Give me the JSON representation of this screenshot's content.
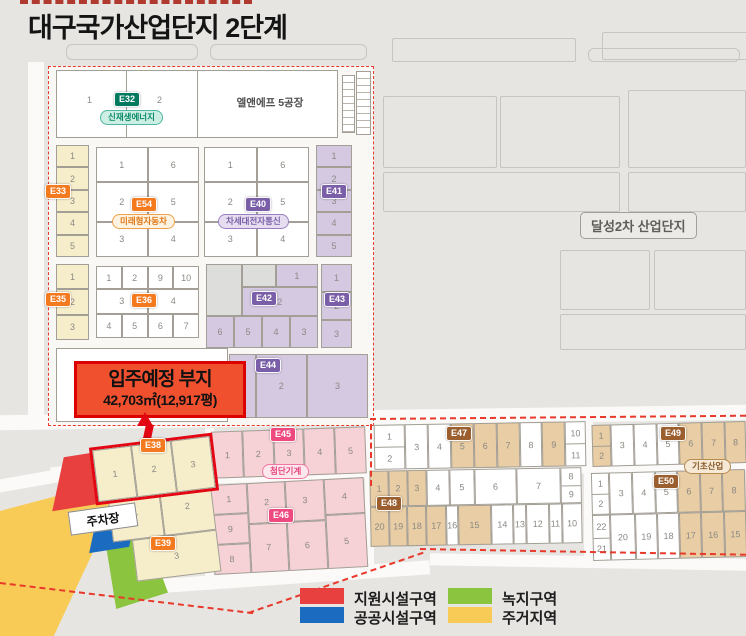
{
  "title": "대구국가산업단지 2단계",
  "neighbor_label": "달성2차 산업단지",
  "callout": {
    "title": "입주예정 부지",
    "area": "42,703㎡(12,917평)"
  },
  "parking_label": "주차장",
  "legend": {
    "items": [
      {
        "label": "지원시설구역",
        "color": "#e8403e"
      },
      {
        "label": "공공시설구역",
        "color": "#1b6cc1"
      },
      {
        "label": "녹지구역",
        "color": "#8bc43e"
      },
      {
        "label": "주거지역",
        "color": "#f8cb57"
      }
    ]
  },
  "palette": {
    "boundary_dashed": "#e8392b",
    "highlight_outline": "#e30613",
    "zone_cream": "#f6eecb",
    "zone_purple": "#d5c9e2",
    "zone_pink": "#f6d2d7",
    "zone_tan": "#e9cda4"
  },
  "blocks": {
    "e32": {
      "code": "E32",
      "industry": "신재생에너지",
      "p1": "1",
      "p2": "2",
      "factory": "엘앤에프 5공장"
    },
    "e33": {
      "code": "E33",
      "cells": [
        {
          "n": "1"
        },
        {
          "n": "2"
        },
        {
          "n": "3"
        },
        {
          "n": "4"
        },
        {
          "n": "5"
        }
      ]
    },
    "e54": {
      "code": "E54",
      "industry": "미래형자동차",
      "r1": [
        {
          "n": "1"
        },
        {
          "n": "6"
        }
      ],
      "r2": [
        {
          "n": "2"
        },
        {
          "n": "5"
        }
      ],
      "r3": [
        {
          "n": "3"
        },
        {
          "n": "4"
        }
      ]
    },
    "e40": {
      "code": "E40",
      "industry": "차세대전자통신",
      "r1": [
        {
          "n": "1"
        },
        {
          "n": "6"
        }
      ],
      "r2": [
        {
          "n": "2"
        },
        {
          "n": "5"
        }
      ],
      "r3": [
        {
          "n": "3"
        },
        {
          "n": "4"
        }
      ]
    },
    "e41": {
      "code": "E41",
      "cells": [
        {
          "n": "1"
        },
        {
          "n": "2"
        },
        {
          "n": "3"
        },
        {
          "n": "4"
        },
        {
          "n": "5"
        }
      ]
    },
    "e35": {
      "code": "E35",
      "cells": [
        {
          "n": "1"
        },
        {
          "n": "2"
        },
        {
          "n": "3"
        }
      ]
    },
    "e36": {
      "code": "E36",
      "top": [
        {
          "n": "1"
        },
        {
          "n": "2"
        },
        {
          "n": "9"
        },
        {
          "n": "10"
        }
      ],
      "mid": [
        {
          "n": "3"
        },
        {
          "n": "4"
        }
      ],
      "bottom": [
        {
          "n": "4"
        },
        {
          "n": "5"
        },
        {
          "n": "6"
        },
        {
          "n": "7"
        }
      ]
    },
    "e42": {
      "code": "E42",
      "p1": "1",
      "p2": "2",
      "bottom": [
        {
          "n": "6"
        },
        {
          "n": "5"
        },
        {
          "n": "4"
        },
        {
          "n": "3"
        }
      ]
    },
    "e43": {
      "code": "E43",
      "cells": [
        {
          "n": "1"
        },
        {
          "n": "2"
        },
        {
          "n": "3"
        }
      ]
    },
    "e44": {
      "code": "E44",
      "cells": [
        {
          "n": "1",
          "w": 0.5
        },
        {
          "n": "2",
          "w": 1
        },
        {
          "n": "3",
          "w": 1.2
        }
      ]
    },
    "e38": {
      "code": "E38",
      "cells": [
        {
          "n": "1"
        },
        {
          "n": "2"
        },
        {
          "n": "3"
        }
      ]
    },
    "e39": {
      "code": "E39",
      "p1": "1",
      "p2": "2",
      "p3": "3"
    },
    "e45": {
      "code": "E45",
      "industry": "첨단기계",
      "cells": [
        {
          "n": "1"
        },
        {
          "n": "2"
        },
        {
          "n": "3"
        },
        {
          "n": "4"
        },
        {
          "n": "5"
        }
      ]
    },
    "e46": {
      "code": "E46",
      "col1": [
        {
          "n": "1"
        },
        {
          "n": "9"
        },
        {
          "n": "8"
        }
      ],
      "col2": [
        {
          "n": "2",
          "w": 0.9
        },
        {
          "n": "7",
          "w": 1.1
        }
      ],
      "col3": [
        {
          "n": "3",
          "w": 0.9
        },
        {
          "n": "6",
          "w": 1.1
        }
      ],
      "col4": [
        {
          "n": "4",
          "w": 0.8
        },
        {
          "n": "5",
          "w": 1.2
        }
      ]
    },
    "e47": {
      "code": "E47",
      "cells": [
        {
          "stack": [
            "1",
            "2"
          ],
          "w": 1.4
        },
        {
          "n": "3"
        },
        {
          "n": "4"
        },
        {
          "n": "5",
          "c": "tan"
        },
        {
          "n": "6",
          "c": "tan"
        },
        {
          "n": "7",
          "c": "tan"
        },
        {
          "n": "8"
        },
        {
          "n": "9",
          "c": "tan"
        },
        {
          "stack": [
            "10",
            "11"
          ],
          "w": 0.9
        }
      ]
    },
    "e48": {
      "code": "E48",
      "top": [
        {
          "n": "1",
          "c": "tan",
          "w": 0.8
        },
        {
          "n": "2",
          "c": "tan",
          "w": 0.8
        },
        {
          "n": "3",
          "c": "tan",
          "w": 0.8
        },
        {
          "n": "4",
          "w": 1
        },
        {
          "n": "5",
          "w": 1.1
        },
        {
          "n": "6",
          "w": 1.9
        },
        {
          "n": "7",
          "w": 2
        },
        {
          "stack": [
            "8",
            "9"
          ],
          "w": 0.9
        }
      ],
      "bottom": [
        {
          "n": "20",
          "c": "tan",
          "w": 0.9
        },
        {
          "n": "19",
          "c": "tan",
          "w": 0.9
        },
        {
          "n": "18",
          "c": "tan",
          "w": 0.9
        },
        {
          "n": "17",
          "c": "tan",
          "w": 1
        },
        {
          "n": "16",
          "w": 0.5
        },
        {
          "n": "15",
          "c": "tan",
          "w": 1.7
        },
        {
          "n": "14",
          "w": 1.1
        },
        {
          "n": "13",
          "w": 0.6
        },
        {
          "n": "12",
          "w": 1.1
        },
        {
          "n": "11",
          "w": 0.6
        },
        {
          "n": "10",
          "w": 1
        }
      ]
    },
    "e49": {
      "code": "E49",
      "industry": "기초산업",
      "cells": [
        {
          "stack": [
            "1",
            "2"
          ],
          "c": "tan",
          "w": 0.8
        },
        {
          "n": "3"
        },
        {
          "n": "4"
        },
        {
          "n": "5"
        },
        {
          "n": "6",
          "c": "tan"
        },
        {
          "n": "7",
          "c": "tan"
        },
        {
          "n": "8",
          "c": "tan",
          "w": 0.9
        }
      ]
    },
    "e50": {
      "code": "E50",
      "top": [
        {
          "stack": [
            "1",
            "2"
          ],
          "w": 0.8
        },
        {
          "n": "3"
        },
        {
          "n": "4"
        },
        {
          "n": "5"
        },
        {
          "n": "6",
          "c": "tan"
        },
        {
          "n": "7",
          "c": "tan"
        },
        {
          "n": "8",
          "c": "tan"
        }
      ],
      "bottom": [
        {
          "stack": [
            "22",
            "21"
          ],
          "w": 0.8
        },
        {
          "n": "20",
          "w": 1.1
        },
        {
          "n": "19"
        },
        {
          "n": "18"
        },
        {
          "n": "17",
          "c": "tan"
        },
        {
          "n": "16",
          "c": "tan"
        },
        {
          "n": "15",
          "c": "tan"
        }
      ]
    }
  }
}
